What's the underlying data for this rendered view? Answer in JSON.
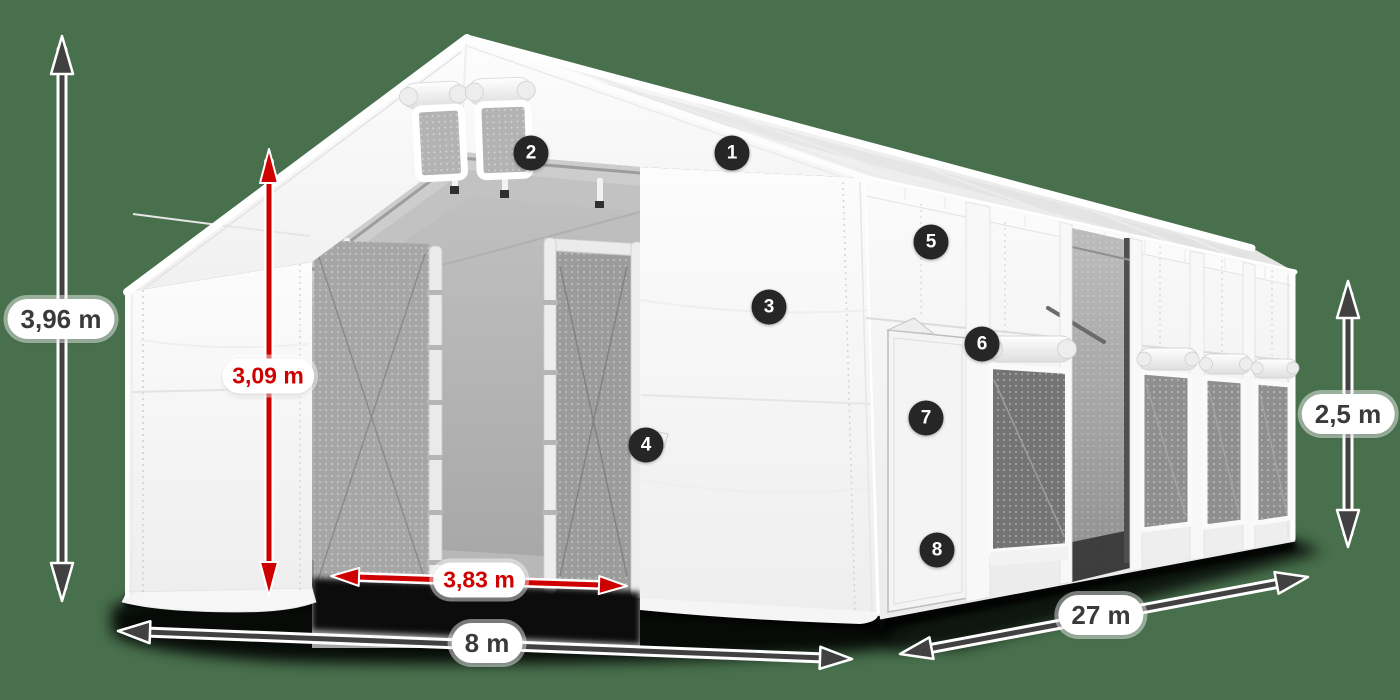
{
  "canvas": {
    "width": 1400,
    "height": 700,
    "background_color": "#48704d"
  },
  "colors": {
    "dimension_arrow": "#414141",
    "highlight_red": "#cf0000",
    "badge_background": "#262626",
    "badge_text": "#ffffff",
    "label_background": "#ffffff",
    "label_text": "#3a3a3a",
    "tent_fabric": "#f6f6f6"
  },
  "measurements": {
    "total_height": "3,96 m",
    "inner_height": "3,09 m",
    "inner_door_width": "3,83 m",
    "width": "8 m",
    "length": "27 m",
    "side_wall_height": "2,5 m"
  },
  "callouts": [
    "1",
    "2",
    "3",
    "4",
    "5",
    "6",
    "7",
    "8"
  ]
}
